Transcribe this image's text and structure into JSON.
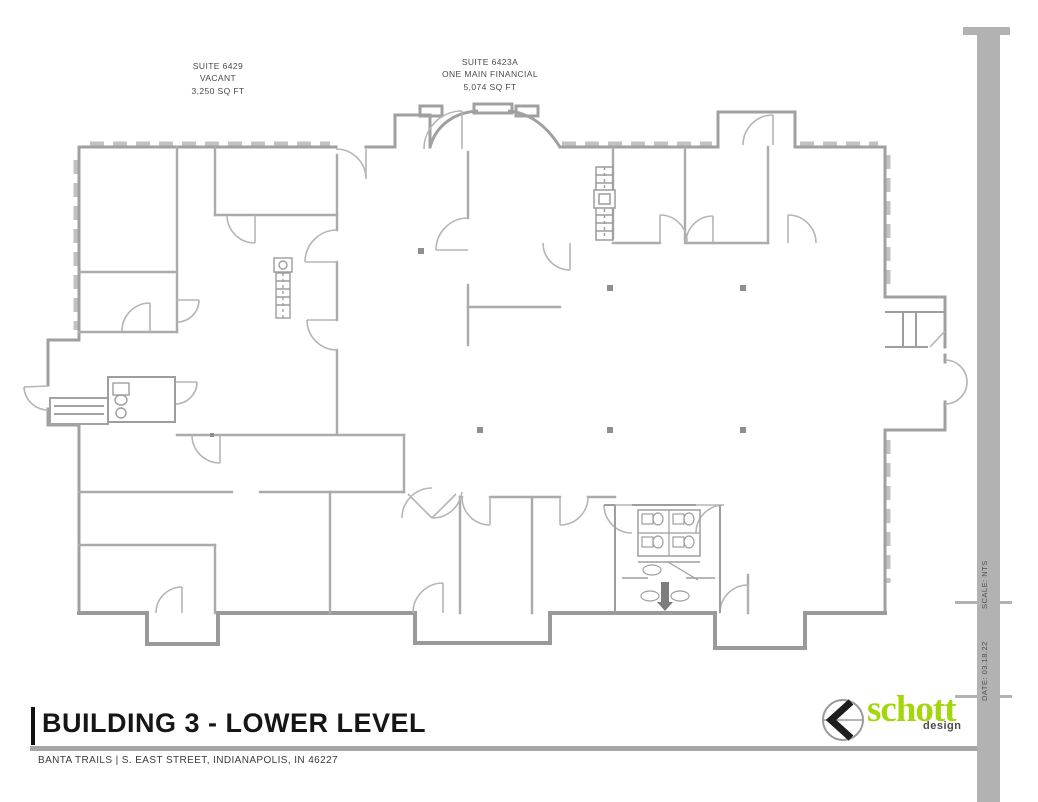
{
  "plan": {
    "suite_labels": [
      {
        "line1": "SUITE 6429",
        "line2": "VACANT",
        "line3": "3,250 SQ FT"
      },
      {
        "line1": "SUITE 6423A",
        "line2": "ONE MAIN FINANCIAL",
        "line3": "5,074 SQ FT"
      }
    ]
  },
  "title_block": {
    "title": "BUILDING 3 - LOWER LEVEL",
    "address": "BANTA TRAILS | S. EAST STREET, INDIANAPOLIS, IN 46227"
  },
  "logo": {
    "name": "schott",
    "suffix": "design"
  },
  "sidebar": {
    "scale": "SCALE: NTS",
    "date": "DATE: 03.18.22"
  },
  "colors": {
    "accent_green": "#a4d60e",
    "wall_gray": "#a6a6a6",
    "window_gray": "#c2c2c2",
    "bar_gray": "#b2b2b2",
    "ink": "#161616"
  }
}
